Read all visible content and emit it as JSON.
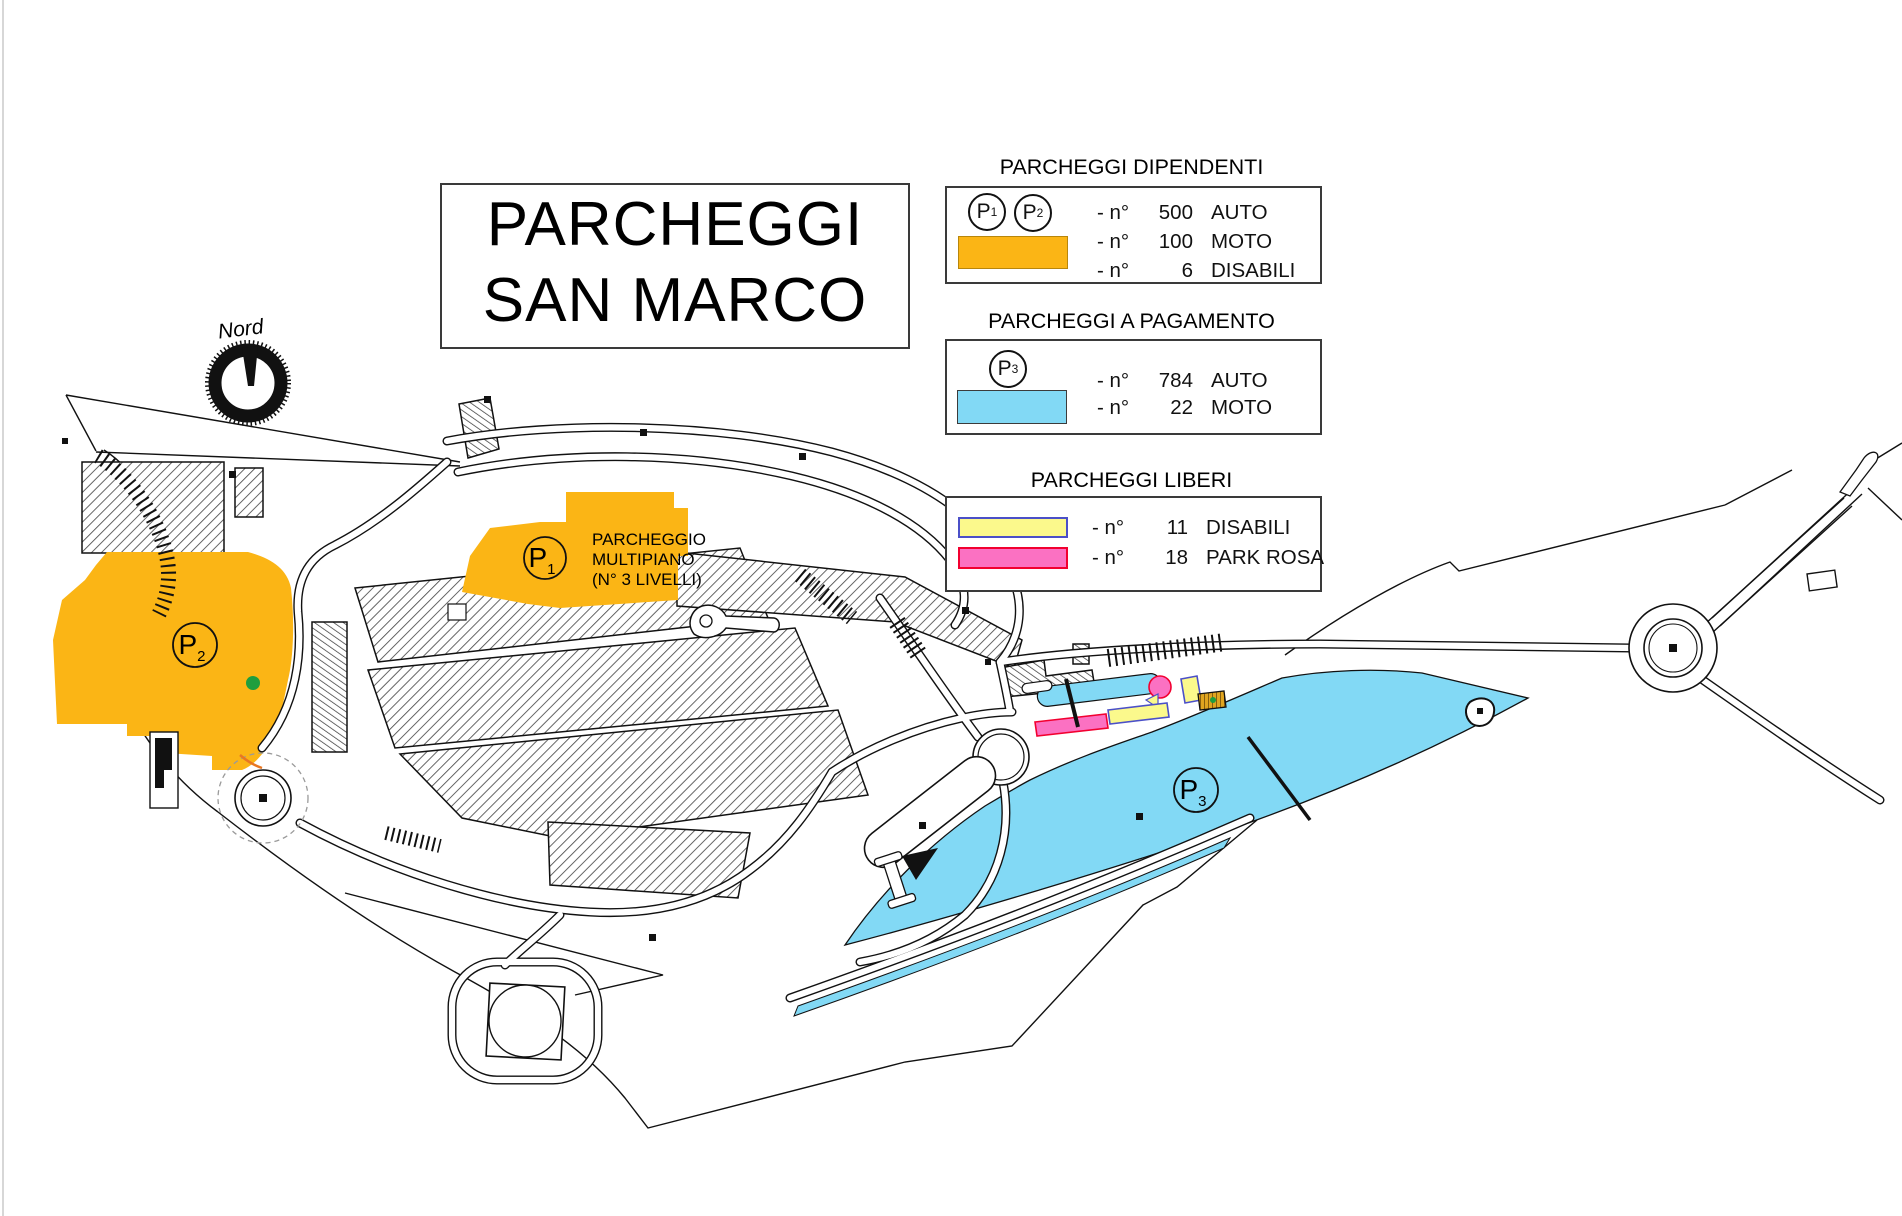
{
  "title": {
    "line1": "PARCHEGGI",
    "line2": "SAN MARCO"
  },
  "compass": {
    "label": "Nord"
  },
  "legend_dipendenti": {
    "header": "PARCHEGGI DIPENDENTI",
    "p1": {
      "label": "P",
      "sub": "1"
    },
    "p2": {
      "label": "P",
      "sub": "2"
    },
    "rows": [
      {
        "prefix": "- n°",
        "num": "500",
        "label": "AUTO"
      },
      {
        "prefix": "- n°",
        "num": "100",
        "label": "MOTO"
      },
      {
        "prefix": "- n°",
        "num": "6",
        "label": "DISABILI"
      }
    ]
  },
  "legend_pagamento": {
    "header": "PARCHEGGI A PAGAMENTO",
    "p3": {
      "label": "P",
      "sub": "3"
    },
    "rows": [
      {
        "prefix": "- n°",
        "num": "784",
        "label": "AUTO"
      },
      {
        "prefix": "- n°",
        "num": "22",
        "label": "MOTO"
      }
    ]
  },
  "legend_liberi": {
    "header": "PARCHEGGI LIBERI",
    "rows": [
      {
        "prefix": "- n°",
        "num": "11",
        "label": "DISABILI"
      },
      {
        "prefix": "- n°",
        "num": "18",
        "label": "PARK ROSA"
      }
    ]
  },
  "map": {
    "p1": {
      "label": "P",
      "sub": "1"
    },
    "p2": {
      "label": "P",
      "sub": "2"
    },
    "p3": {
      "label": "P",
      "sub": "3"
    },
    "p1_info": [
      "PARCHEGGIO",
      "MULTIPIANO",
      "(N° 3 LIVELLI)"
    ]
  },
  "colors": {
    "employee_orange": "#FBB515",
    "paid_blue": "#82D9F5",
    "free_disabled_yellow": "#FBF98C",
    "park_rosa_pink": "#FB71C2",
    "building_hatch": "#4a4a4a",
    "tree_green": "#1F9E3E"
  }
}
